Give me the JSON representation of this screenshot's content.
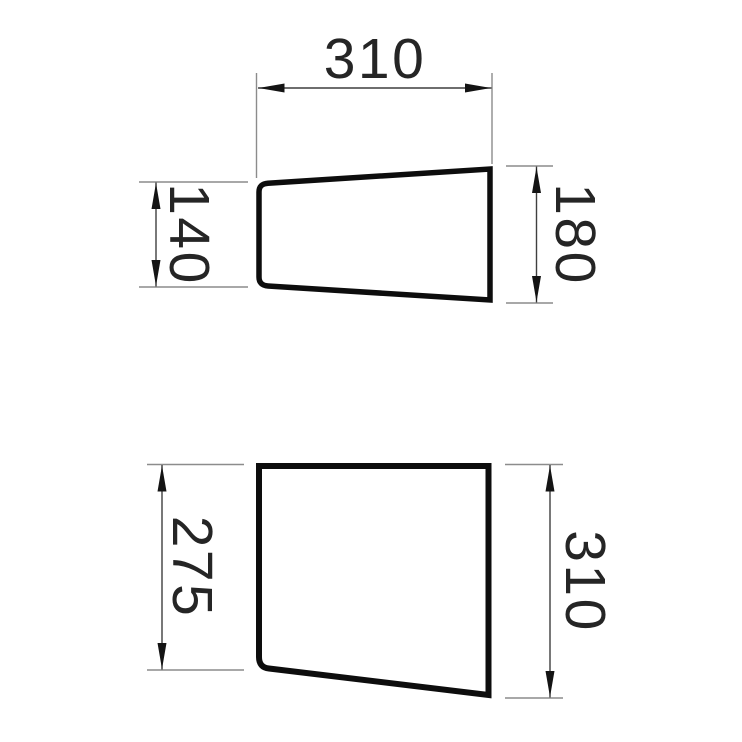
{
  "drawing": {
    "kind": "technical-dimension-drawing",
    "colors": {
      "background": "#ffffff",
      "outline": "#0d0d0d",
      "dimension_line": "#3f3f3f",
      "extension_line": "#8c8c8c",
      "arrow": "#141414",
      "text": "#252525"
    },
    "views": [
      {
        "id": "upper-profile",
        "dims": {
          "top_width": "310",
          "left_height": "140",
          "right_height": "180"
        }
      },
      {
        "id": "lower-profile",
        "dims": {
          "left_height": "275",
          "right_height": "310"
        }
      }
    ]
  }
}
